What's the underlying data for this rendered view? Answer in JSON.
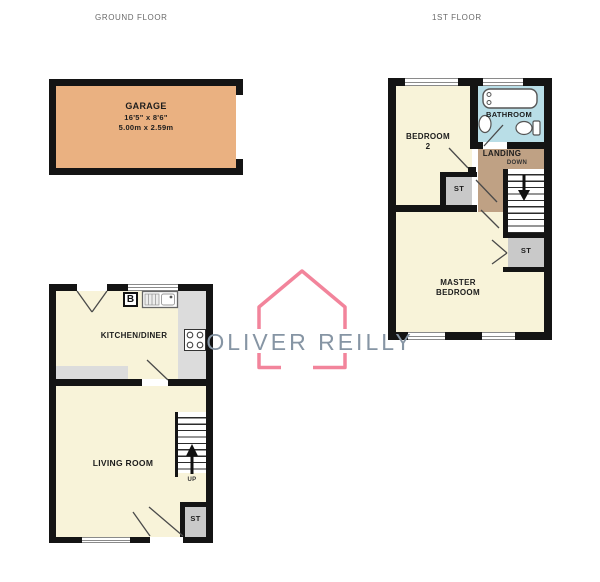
{
  "titles": {
    "ground": "GROUND FLOOR",
    "first": "1ST FLOOR"
  },
  "garage": {
    "label": "GARAGE",
    "imperial": "16'5\" x 8'6\"",
    "metric": "5.00m x 2.59m"
  },
  "ground": {
    "kitchen_label": "KITCHEN/DINER",
    "boiler": "B",
    "living_label": "LIVING ROOM",
    "up": "UP",
    "store": "ST"
  },
  "first": {
    "bedroom2_line1": "BEDROOM",
    "bedroom2_line2": "2",
    "bathroom_label": "BATHROOM",
    "landing_label": "LANDING",
    "down": "DOWN",
    "master_line1": "MASTER",
    "master_line2": "BEDROOM",
    "store1": "ST",
    "store2": "ST"
  },
  "watermark": {
    "text": "OLIVER REILLY"
  },
  "colors": {
    "wall": "#141414",
    "garage_fill": "#eab181",
    "room_fill": "#f8f3d9",
    "counter_fill": "#dcdcdc",
    "store_fill": "#c9c9c9",
    "bathroom_fill": "#b9dee7",
    "landing_fill": "#bfa184",
    "logo_pink": "#f2849b",
    "logo_text": "#8695a4"
  }
}
